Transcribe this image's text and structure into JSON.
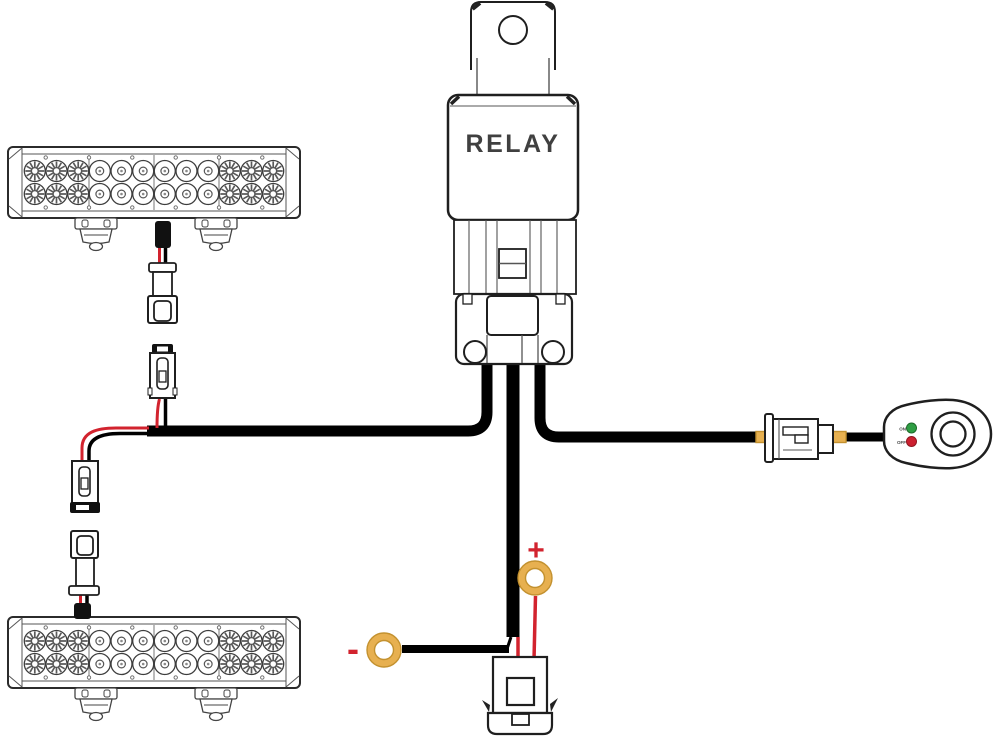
{
  "diagram": {
    "relay": {
      "label": "RELAY"
    },
    "battery": {
      "positive_label": "+",
      "negative_label": "-"
    },
    "switch": {
      "on_label": "ON",
      "off_label": "OFF"
    },
    "light_bars": {
      "count": 2,
      "leds_per_bar": 24,
      "rows": 2,
      "columns": 12
    },
    "components": [
      "led-light-bar-top",
      "led-light-bar-bottom",
      "relay",
      "relay-socket",
      "harness-connector-top",
      "harness-connector-bottom",
      "lightbar-plug-top",
      "lightbar-plug-bottom",
      "inline-switch-connector",
      "power-switch",
      "fuse-holder",
      "positive-ring-terminal",
      "negative-ring-terminal"
    ]
  },
  "colors": {
    "wire-black": "#000000",
    "wire-red": "#d2232e",
    "terminal-gold": "#e7b050",
    "terminal-gold-edge": "#c3912f",
    "led-on-green": "#2f9e44",
    "led-off-red": "#cc2030",
    "outline": "#1f1f1f",
    "relay-text": "#404040"
  }
}
